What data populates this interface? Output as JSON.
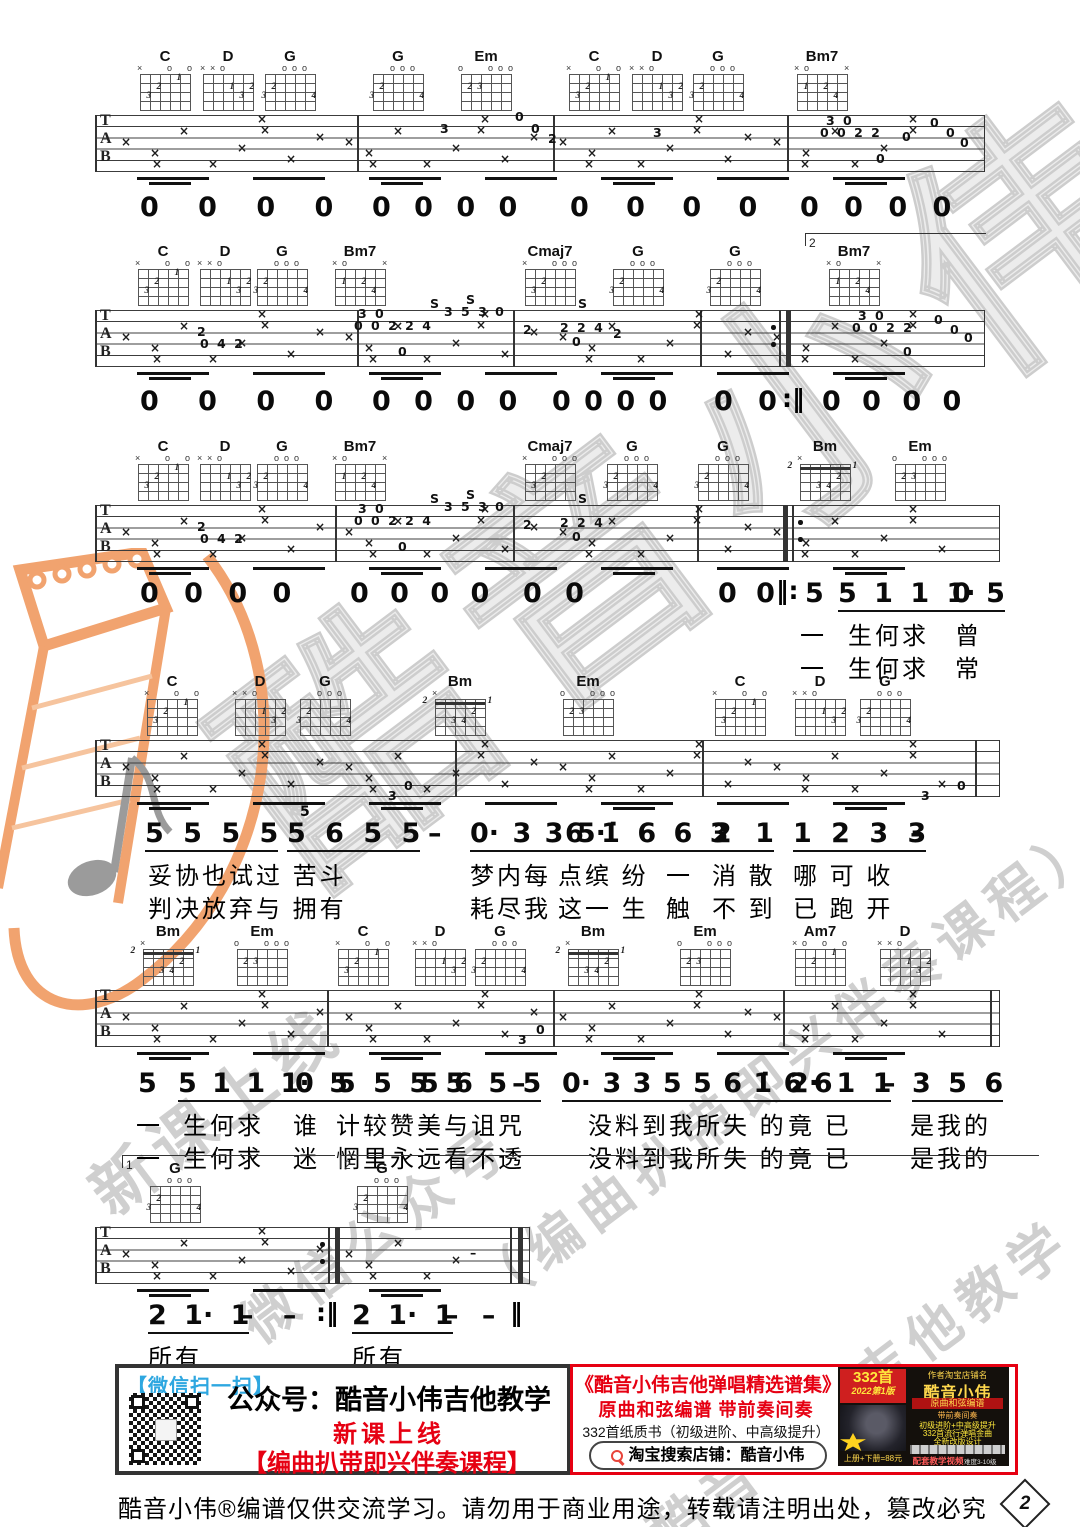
{
  "colors": {
    "red": "#e60012",
    "blue": "#2ea7e0",
    "orange": "#f1a36f",
    "watermark_gray": "#cfcfcf"
  },
  "staff_letters": [
    "T",
    "A",
    "B"
  ],
  "watermarks": {
    "main": "酷音小伟",
    "w1": "新课上线",
    "w2": "微信公众号",
    "w3": "（编曲扒带即兴伴奏课程）",
    "w4": "酷音小伟吉他教学"
  },
  "chord_shapes": {
    "C": {
      "marks": [
        "x",
        "",
        "",
        "o",
        "",
        "o"
      ],
      "dots": [
        [
          2,
          3,
          "3"
        ],
        [
          3,
          2,
          "2"
        ],
        [
          5,
          1,
          "1"
        ]
      ]
    },
    "D": {
      "marks": [
        "x",
        "x",
        "o",
        "",
        "",
        ""
      ],
      "dots": [
        [
          4,
          2,
          "1"
        ],
        [
          6,
          2,
          "2"
        ],
        [
          5,
          3,
          "3"
        ]
      ]
    },
    "G": {
      "marks": [
        "",
        "",
        "o",
        "o",
        "o",
        ""
      ],
      "dots": [
        [
          2,
          2,
          "2"
        ],
        [
          1,
          3,
          "3"
        ],
        [
          6,
          3,
          "4"
        ]
      ]
    },
    "Em": {
      "marks": [
        "o",
        "",
        "",
        "o",
        "o",
        "o"
      ],
      "dots": [
        [
          2,
          2,
          "2"
        ],
        [
          3,
          2,
          "3"
        ]
      ]
    },
    "Bm7": {
      "marks": [
        "x",
        "o",
        "",
        "",
        "",
        "x"
      ],
      "dots": [
        [
          2,
          2,
          "1"
        ],
        [
          4,
          2,
          "2"
        ],
        [
          5,
          3,
          "4"
        ]
      ]
    },
    "Cmaj7": {
      "marks": [
        "x",
        "",
        "",
        "o",
        "o",
        "o"
      ],
      "dots": [
        [
          2,
          3,
          "3"
        ],
        [
          3,
          2,
          "2"
        ]
      ]
    },
    "Bm": {
      "marks": [
        "x",
        "",
        "",
        "",
        "",
        ""
      ],
      "pos": "2",
      "barre": true,
      "dots": [
        [
          5,
          2,
          "2"
        ],
        [
          3,
          3,
          "3"
        ],
        [
          4,
          3,
          "4"
        ]
      ]
    },
    "Am7": {
      "marks": [
        "x",
        "o",
        "",
        "o",
        "",
        "o"
      ],
      "dots": [
        [
          5,
          1,
          "1"
        ],
        [
          3,
          2,
          "2"
        ]
      ]
    }
  },
  "systems": [
    {
      "staff": {
        "x": 95,
        "y": 115,
        "w": 890
      },
      "numY": 192,
      "chords": [
        {
          "n": "C",
          "x": 165
        },
        {
          "n": "D",
          "x": 228
        },
        {
          "n": "G",
          "x": 290
        },
        {
          "n": "G",
          "x": 398
        },
        {
          "n": "Em",
          "x": 486
        },
        {
          "n": "C",
          "x": 594
        },
        {
          "n": "D",
          "x": 657
        },
        {
          "n": "G",
          "x": 718
        },
        {
          "n": "Bm7",
          "x": 822
        }
      ],
      "bars": [
        357,
        553,
        787
      ],
      "extras": [
        {
          "x": 440,
          "y": 6,
          "t": "3"
        },
        {
          "x": 515,
          "y": -6,
          "t": "0"
        },
        {
          "x": 531,
          "y": 6,
          "t": "0"
        },
        {
          "x": 548,
          "y": 16,
          "t": "2"
        },
        {
          "x": 653,
          "y": 10,
          "t": "3"
        },
        {
          "x": 826,
          "y": -2,
          "t": "3 0"
        },
        {
          "x": 820,
          "y": 10,
          "t": "0 0 2 2"
        },
        {
          "x": 902,
          "y": 14,
          "t": "0"
        },
        {
          "x": 930,
          "y": 0,
          "t": "0"
        },
        {
          "x": 946,
          "y": 10,
          "t": "0"
        },
        {
          "x": 960,
          "y": 20,
          "t": "0"
        },
        {
          "x": 876,
          "y": 36,
          "t": "0"
        }
      ],
      "nums": [
        {
          "x": 140,
          "t": "0 0 0 0",
          "ws": 30
        },
        {
          "x": 372,
          "t": "0 0 0 0",
          "ws": 14
        },
        {
          "x": 570,
          "t": "0 0 0 0",
          "ws": 28
        },
        {
          "x": 800,
          "t": "0 0 0 0",
          "ws": 16
        }
      ]
    },
    {
      "staff": {
        "x": 95,
        "y": 310,
        "w": 890
      },
      "numY": 386,
      "chords": [
        {
          "n": "C",
          "x": 163
        },
        {
          "n": "D",
          "x": 225
        },
        {
          "n": "G",
          "x": 282
        },
        {
          "n": "Bm7",
          "x": 360
        },
        {
          "n": "Cmaj7",
          "x": 550
        },
        {
          "n": "G",
          "x": 638
        },
        {
          "n": "G",
          "x": 735
        },
        {
          "n": "Bm7",
          "x": 854
        }
      ],
      "bars": [
        357,
        513,
        700
      ],
      "repeats": [
        {
          "x": 786,
          "type": "end"
        }
      ],
      "voltas": [
        {
          "x": 805,
          "y": 233,
          "w": 180,
          "label": "2"
        }
      ],
      "extras": [
        {
          "x": 197,
          "y": 14,
          "t": "2"
        },
        {
          "x": 200,
          "y": 26,
          "t": "0 4 2"
        },
        {
          "x": 358,
          "y": -4,
          "t": "3 0"
        },
        {
          "x": 354,
          "y": 8,
          "t": "0 0 2 2 4"
        },
        {
          "x": 430,
          "y": -14,
          "t": "S"
        },
        {
          "x": 466,
          "y": -18,
          "t": "S"
        },
        {
          "x": 444,
          "y": -6,
          "t": "3 5 3 0"
        },
        {
          "x": 523,
          "y": 12,
          "t": "2"
        },
        {
          "x": 398,
          "y": 34,
          "t": "0"
        },
        {
          "x": 578,
          "y": -14,
          "t": "S"
        },
        {
          "x": 560,
          "y": 10,
          "t": "2 2 4"
        },
        {
          "x": 572,
          "y": 24,
          "t": "0"
        },
        {
          "x": 613,
          "y": 16,
          "t": "2"
        },
        {
          "x": 858,
          "y": -2,
          "t": "3 0"
        },
        {
          "x": 852,
          "y": 10,
          "t": "0 0 2 2"
        },
        {
          "x": 934,
          "y": 2,
          "t": "0"
        },
        {
          "x": 950,
          "y": 12,
          "t": "0"
        },
        {
          "x": 903,
          "y": 34,
          "t": "0"
        },
        {
          "x": 964,
          "y": 20,
          "t": "0"
        }
      ],
      "nums": [
        {
          "x": 140,
          "t": "0 0 0 0",
          "ws": 30
        },
        {
          "x": 372,
          "t": "0 0 0 0",
          "ws": 14
        },
        {
          "x": 552,
          "t": "0 0 0 0",
          "ws": 4
        },
        {
          "x": 714,
          "t": "0 0",
          "ws": 16
        },
        {
          "x": 822,
          "t": "0 0 0 0",
          "ws": 12
        }
      ],
      "nrep": [
        {
          "x": 782,
          "t": ":‖"
        }
      ]
    },
    {
      "staff": {
        "x": 95,
        "y": 505,
        "w": 905
      },
      "numY": 578,
      "chords": [
        {
          "n": "C",
          "x": 163
        },
        {
          "n": "D",
          "x": 225
        },
        {
          "n": "G",
          "x": 282
        },
        {
          "n": "Bm7",
          "x": 360
        },
        {
          "n": "Cmaj7",
          "x": 550
        },
        {
          "n": "G",
          "x": 632
        },
        {
          "n": "G",
          "x": 723
        },
        {
          "n": "Bm",
          "x": 825
        },
        {
          "n": "Em",
          "x": 920
        }
      ],
      "bars": [
        335,
        513,
        697
      ],
      "repeats": [
        {
          "x": 783,
          "type": "begin"
        }
      ],
      "extras": [
        {
          "x": 197,
          "y": 14,
          "t": "2"
        },
        {
          "x": 200,
          "y": 26,
          "t": "0 4 2"
        },
        {
          "x": 358,
          "y": -4,
          "t": "3 0"
        },
        {
          "x": 354,
          "y": 8,
          "t": "0 0 2 2 4"
        },
        {
          "x": 430,
          "y": -14,
          "t": "S"
        },
        {
          "x": 466,
          "y": -18,
          "t": "S"
        },
        {
          "x": 444,
          "y": -6,
          "t": "3 5 3 0"
        },
        {
          "x": 523,
          "y": 12,
          "t": "2"
        },
        {
          "x": 398,
          "y": 34,
          "t": "0"
        },
        {
          "x": 578,
          "y": -14,
          "t": "S"
        },
        {
          "x": 560,
          "y": 10,
          "t": "2 2 4"
        },
        {
          "x": 572,
          "y": 24,
          "t": "0"
        }
      ],
      "nums": [
        {
          "x": 140,
          "t": "0 0 0 0",
          "ws": 16
        },
        {
          "x": 350,
          "t": "0 0 0 0",
          "ws": 12
        },
        {
          "x": 523,
          "t": "0 0",
          "ws": 14
        },
        {
          "x": 718,
          "t": "0 0",
          "ws": 10
        },
        {
          "x": 805,
          "t": "5"
        },
        {
          "x": 838,
          "t": "5 1 1 1·",
          "u": 1,
          "ws": 8
        },
        {
          "x": 952,
          "t": "0 5",
          "u": 1,
          "ws": 6
        }
      ],
      "nrep": [
        {
          "x": 776,
          "t": "‖:"
        }
      ],
      "lyr": [
        [
          {
            "x": 800,
            "t": "一"
          },
          {
            "x": 848,
            "t": "生何求"
          },
          {
            "x": 955,
            "t": "曾"
          }
        ],
        [
          {
            "x": 800,
            "t": "一"
          },
          {
            "x": 848,
            "t": "生何求"
          },
          {
            "x": 955,
            "t": "常"
          }
        ]
      ]
    },
    {
      "staff": {
        "x": 95,
        "y": 740,
        "w": 905
      },
      "numY": 818,
      "chords": [
        {
          "n": "C",
          "x": 172
        },
        {
          "n": "D",
          "x": 260
        },
        {
          "n": "G",
          "x": 325
        },
        {
          "n": "Bm",
          "x": 460
        },
        {
          "n": "Em",
          "x": 588
        },
        {
          "n": "C",
          "x": 740
        },
        {
          "n": "D",
          "x": 820
        },
        {
          "n": "G",
          "x": 885
        }
      ],
      "bars": [
        455,
        702,
        975
      ],
      "extras": [
        {
          "x": 388,
          "y": 48,
          "t": "3"
        },
        {
          "x": 404,
          "y": 38,
          "t": "0"
        },
        {
          "x": 921,
          "y": 48,
          "t": "3"
        },
        {
          "x": 957,
          "y": 38,
          "t": "0"
        }
      ],
      "nums": [
        {
          "x": 145,
          "t": "5 5 5 5",
          "u": 1,
          "ws": 10
        },
        {
          "x": 287,
          "t": "5 6 5 5",
          "u": 1,
          "ws": 10
        },
        {
          "x": 300,
          "t": "5",
          "small": 1
        },
        {
          "x": 428,
          "t": "–"
        },
        {
          "x": 470,
          "t": "0· 3 3 5·",
          "u": 1,
          "ws": 4
        },
        {
          "x": 565,
          "t": "6 1̇ 6 6 3",
          "u": 1,
          "ws": 8
        },
        {
          "x": 713,
          "t": "2 1",
          "u": 1,
          "ws": 14
        },
        {
          "x": 793,
          "t": "1 2 3 3",
          "u": 1,
          "ws": 10
        },
        {
          "x": 910,
          "t": "–"
        }
      ],
      "lyr": [
        [
          {
            "x": 148,
            "t": "妥协也试过 苦斗"
          },
          {
            "x": 470,
            "t": "梦内每"
          },
          {
            "x": 558,
            "t": "点缤 纷"
          },
          {
            "x": 666,
            "t": "一"
          },
          {
            "x": 712,
            "t": "消 散"
          },
          {
            "x": 793,
            "t": "哪 可 收"
          }
        ],
        [
          {
            "x": 148,
            "t": "判决放弃与 拥有"
          },
          {
            "x": 470,
            "t": "耗尽我"
          },
          {
            "x": 558,
            "t": "这一 生"
          },
          {
            "x": 666,
            "t": "触"
          },
          {
            "x": 712,
            "t": "不 到"
          },
          {
            "x": 793,
            "t": "已 跑 开"
          }
        ]
      ]
    },
    {
      "staff": {
        "x": 95,
        "y": 990,
        "w": 905
      },
      "numY": 1068,
      "chords": [
        {
          "n": "Bm",
          "x": 168
        },
        {
          "n": "Em",
          "x": 262
        },
        {
          "n": "C",
          "x": 363
        },
        {
          "n": "D",
          "x": 440
        },
        {
          "n": "G",
          "x": 500
        },
        {
          "n": "Bm",
          "x": 593
        },
        {
          "n": "Em",
          "x": 705
        },
        {
          "n": "Am7",
          "x": 820
        },
        {
          "n": "D",
          "x": 905
        }
      ],
      "bars": [
        327,
        553,
        783,
        990
      ],
      "extras": [
        {
          "x": 518,
          "y": 42,
          "t": "3"
        },
        {
          "x": 536,
          "y": 32,
          "t": "0"
        }
      ],
      "nums": [
        {
          "x": 138,
          "t": "5"
        },
        {
          "x": 178,
          "t": "5 1 1 1·",
          "u": 1,
          "ws": 6
        },
        {
          "x": 295,
          "t": "0 5",
          "u": 1,
          "ws": 6
        },
        {
          "x": 337,
          "t": "5 5 5 5",
          "u": 1,
          "ws": 8
        },
        {
          "x": 420,
          "t": "5 6 5 5",
          "u": 1,
          "ws": 6
        },
        {
          "x": 512,
          "t": "–"
        },
        {
          "x": 562,
          "t": "0· 3 3 5 5 6 1̇ 6 6",
          "u": 1,
          "ws": 2
        },
        {
          "x": 790,
          "t": "2· 1 1",
          "u": 1,
          "ws": 8
        },
        {
          "x": 882,
          "t": "–"
        },
        {
          "x": 912,
          "t": "3 5 6",
          "u": 1,
          "ws": 8
        }
      ],
      "lyr": [
        [
          {
            "x": 136,
            "t": "一"
          },
          {
            "x": 183,
            "t": "生何求"
          },
          {
            "x": 293,
            "t": "谁"
          },
          {
            "x": 336,
            "t": "计较赞美与诅咒"
          },
          {
            "x": 588,
            "t": "没料到我所失 的"
          },
          {
            "x": 788,
            "t": "竟 已"
          },
          {
            "x": 910,
            "t": "是我的"
          }
        ],
        [
          {
            "x": 136,
            "t": "一"
          },
          {
            "x": 183,
            "t": "生何求"
          },
          {
            "x": 293,
            "t": "迷"
          },
          {
            "x": 336,
            "t": "惘里永远看不透"
          },
          {
            "x": 588,
            "t": "没料到我所失 的"
          },
          {
            "x": 788,
            "t": "竟 已"
          },
          {
            "x": 910,
            "t": "是我的"
          }
        ]
      ]
    },
    {
      "staff": {
        "x": 95,
        "y": 1227,
        "w": 435
      },
      "numY": 1300,
      "chords": [
        {
          "n": "G",
          "x": 175
        },
        {
          "n": "G",
          "x": 382
        }
      ],
      "bars": [],
      "repeats": [
        {
          "x": 335,
          "type": "end"
        },
        {
          "x": 518,
          "type": "final"
        }
      ],
      "voltas": [
        {
          "x": 122,
          "y": 1155,
          "w": 212,
          "label": "1"
        },
        {
          "x": 340,
          "y": 1155,
          "w": 698,
          "label": "2"
        }
      ],
      "extras": [
        {
          "x": 470,
          "y": 18,
          "t": "–"
        }
      ],
      "nums": [
        {
          "x": 148,
          "t": "2 1· 1",
          "u": 1,
          "ws": 8
        },
        {
          "x": 240,
          "t": "– –",
          "ws": 20
        },
        {
          "x": 352,
          "t": "2 1· 1",
          "u": 1,
          "ws": 8
        },
        {
          "x": 445,
          "t": "– –",
          "ws": 14
        }
      ],
      "nrep": [
        {
          "x": 316,
          "t": ":‖"
        },
        {
          "x": 510,
          "t": "‖"
        }
      ],
      "lyr": [
        [
          {
            "x": 148,
            "t": "所有"
          },
          {
            "x": 352,
            "t": "所有"
          }
        ]
      ]
    }
  ],
  "footer": {
    "left": {
      "scan": "【微信扫一扫】",
      "account": "公众号：酷音小伟吉他教学",
      "newcourse": "新课上线",
      "course": "【编曲扒带即兴伴奏课程】"
    },
    "right": {
      "title": "《酷音小伟吉他弹唱精选谱集》",
      "sub": "原曲和弦编谱  带前奏间奏",
      "desc": "332首纸质书（初级进阶、中高级提升）",
      "search": "淘宝搜索店铺：酷音小伟"
    },
    "ad": {
      "count": "332首",
      "edition": "2022第1版",
      "shop_label": "作者淘宝店铺名",
      "shop": "酷音小伟",
      "line1": "原曲和弦编谱",
      "line2": "带前奏间奏",
      "f1": "初级进阶+中高级提升",
      "f2": "332首流行弹唱金曲",
      "f3": "全新改版设计",
      "video": "配套教学视频",
      "price": "上册+下册=88元",
      "grade": "难度3-10级"
    }
  },
  "page_info": {
    "note": "酷音小伟®编谱仅供交流学习。请勿用于商业用途，转载请注明出处，篡改必究",
    "page_number": "2"
  }
}
